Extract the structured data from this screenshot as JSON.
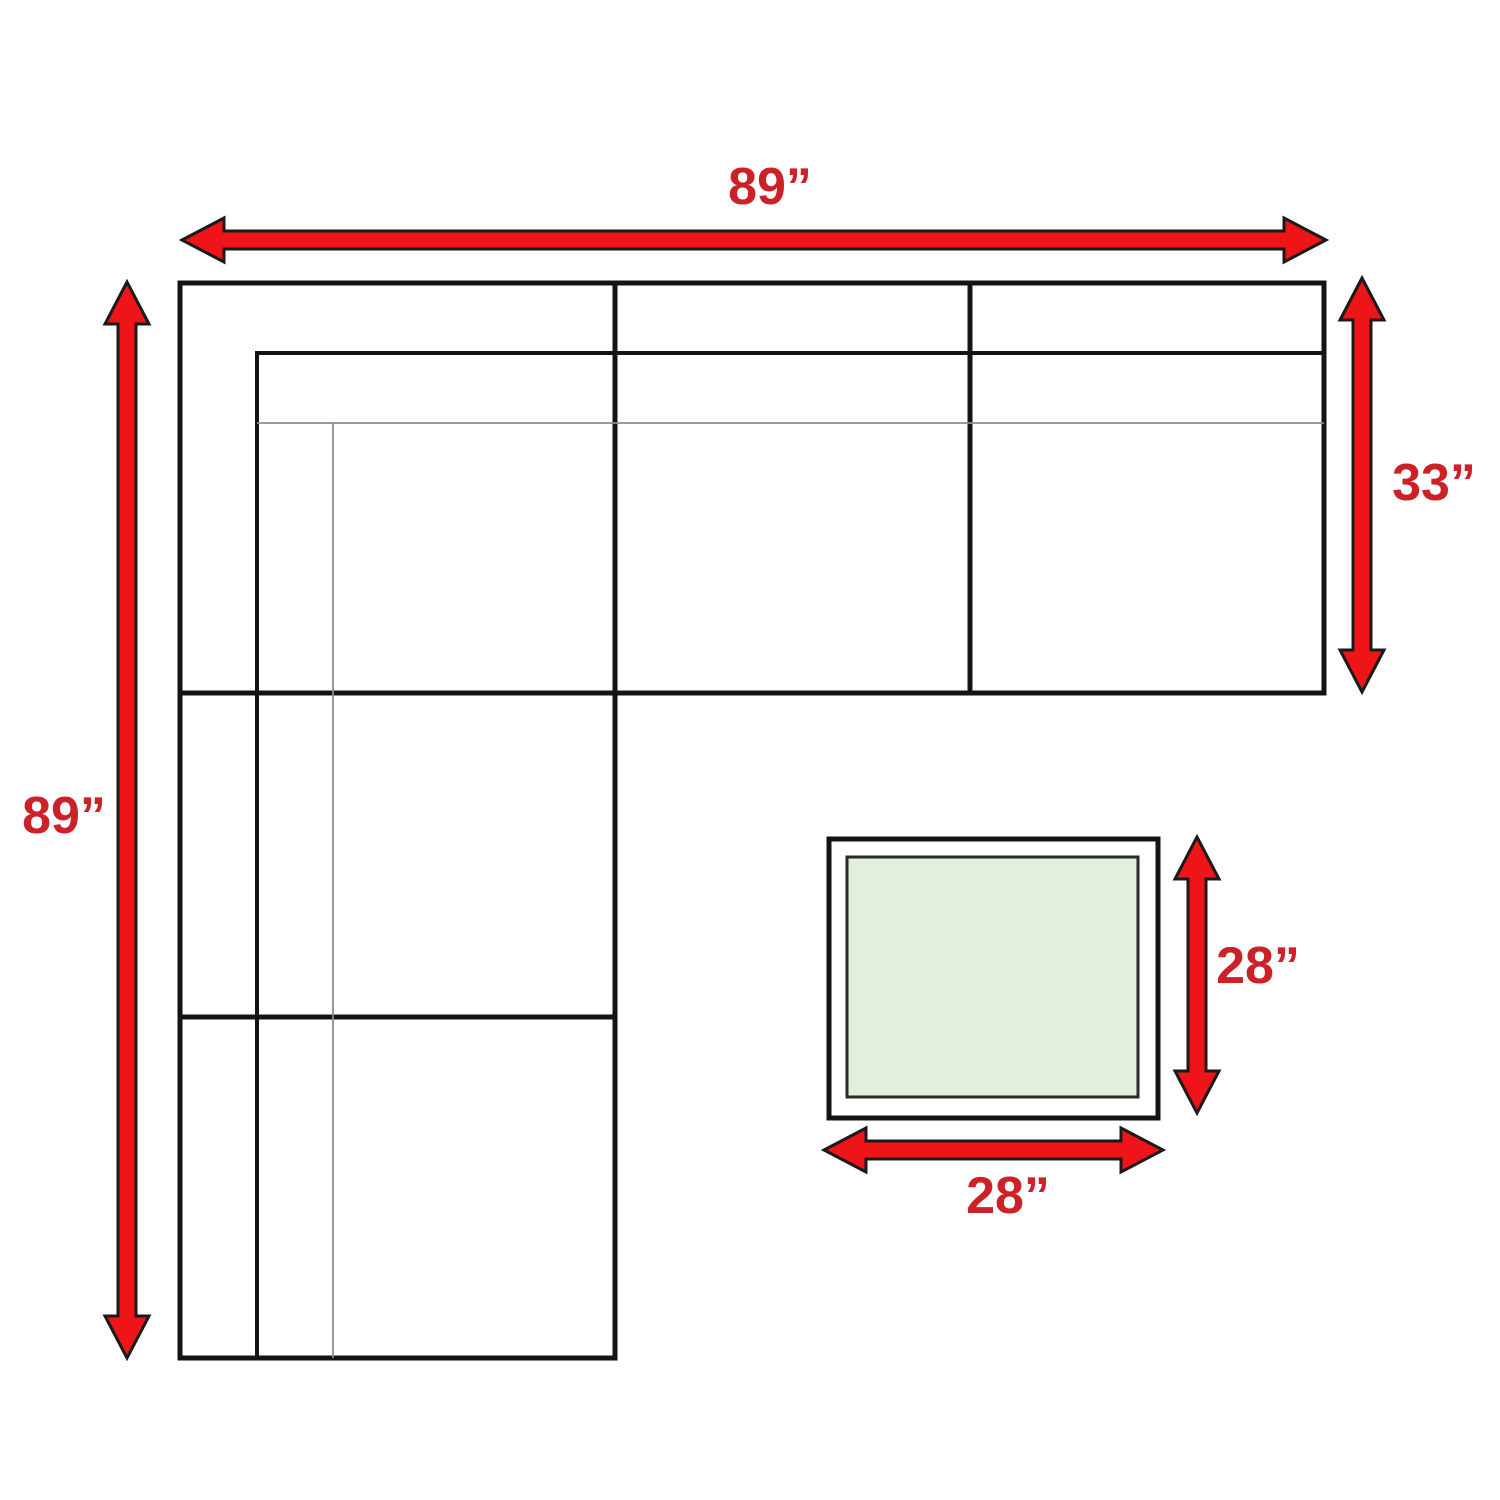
{
  "diagram": {
    "subject": "Sectional sofa with ottoman dimension plan",
    "measurements": {
      "top_width": "89”",
      "left_height": "89”",
      "right_depth": "33”",
      "ottoman_height": "28”",
      "ottoman_width": "28”"
    },
    "colors": {
      "arrow_red": "#ee1418",
      "label_red": "#cb2127",
      "line_black": "#141414",
      "line_gray": "#8c8c8c",
      "ottoman_green": "#e3efda",
      "background": "#ffffff"
    }
  }
}
